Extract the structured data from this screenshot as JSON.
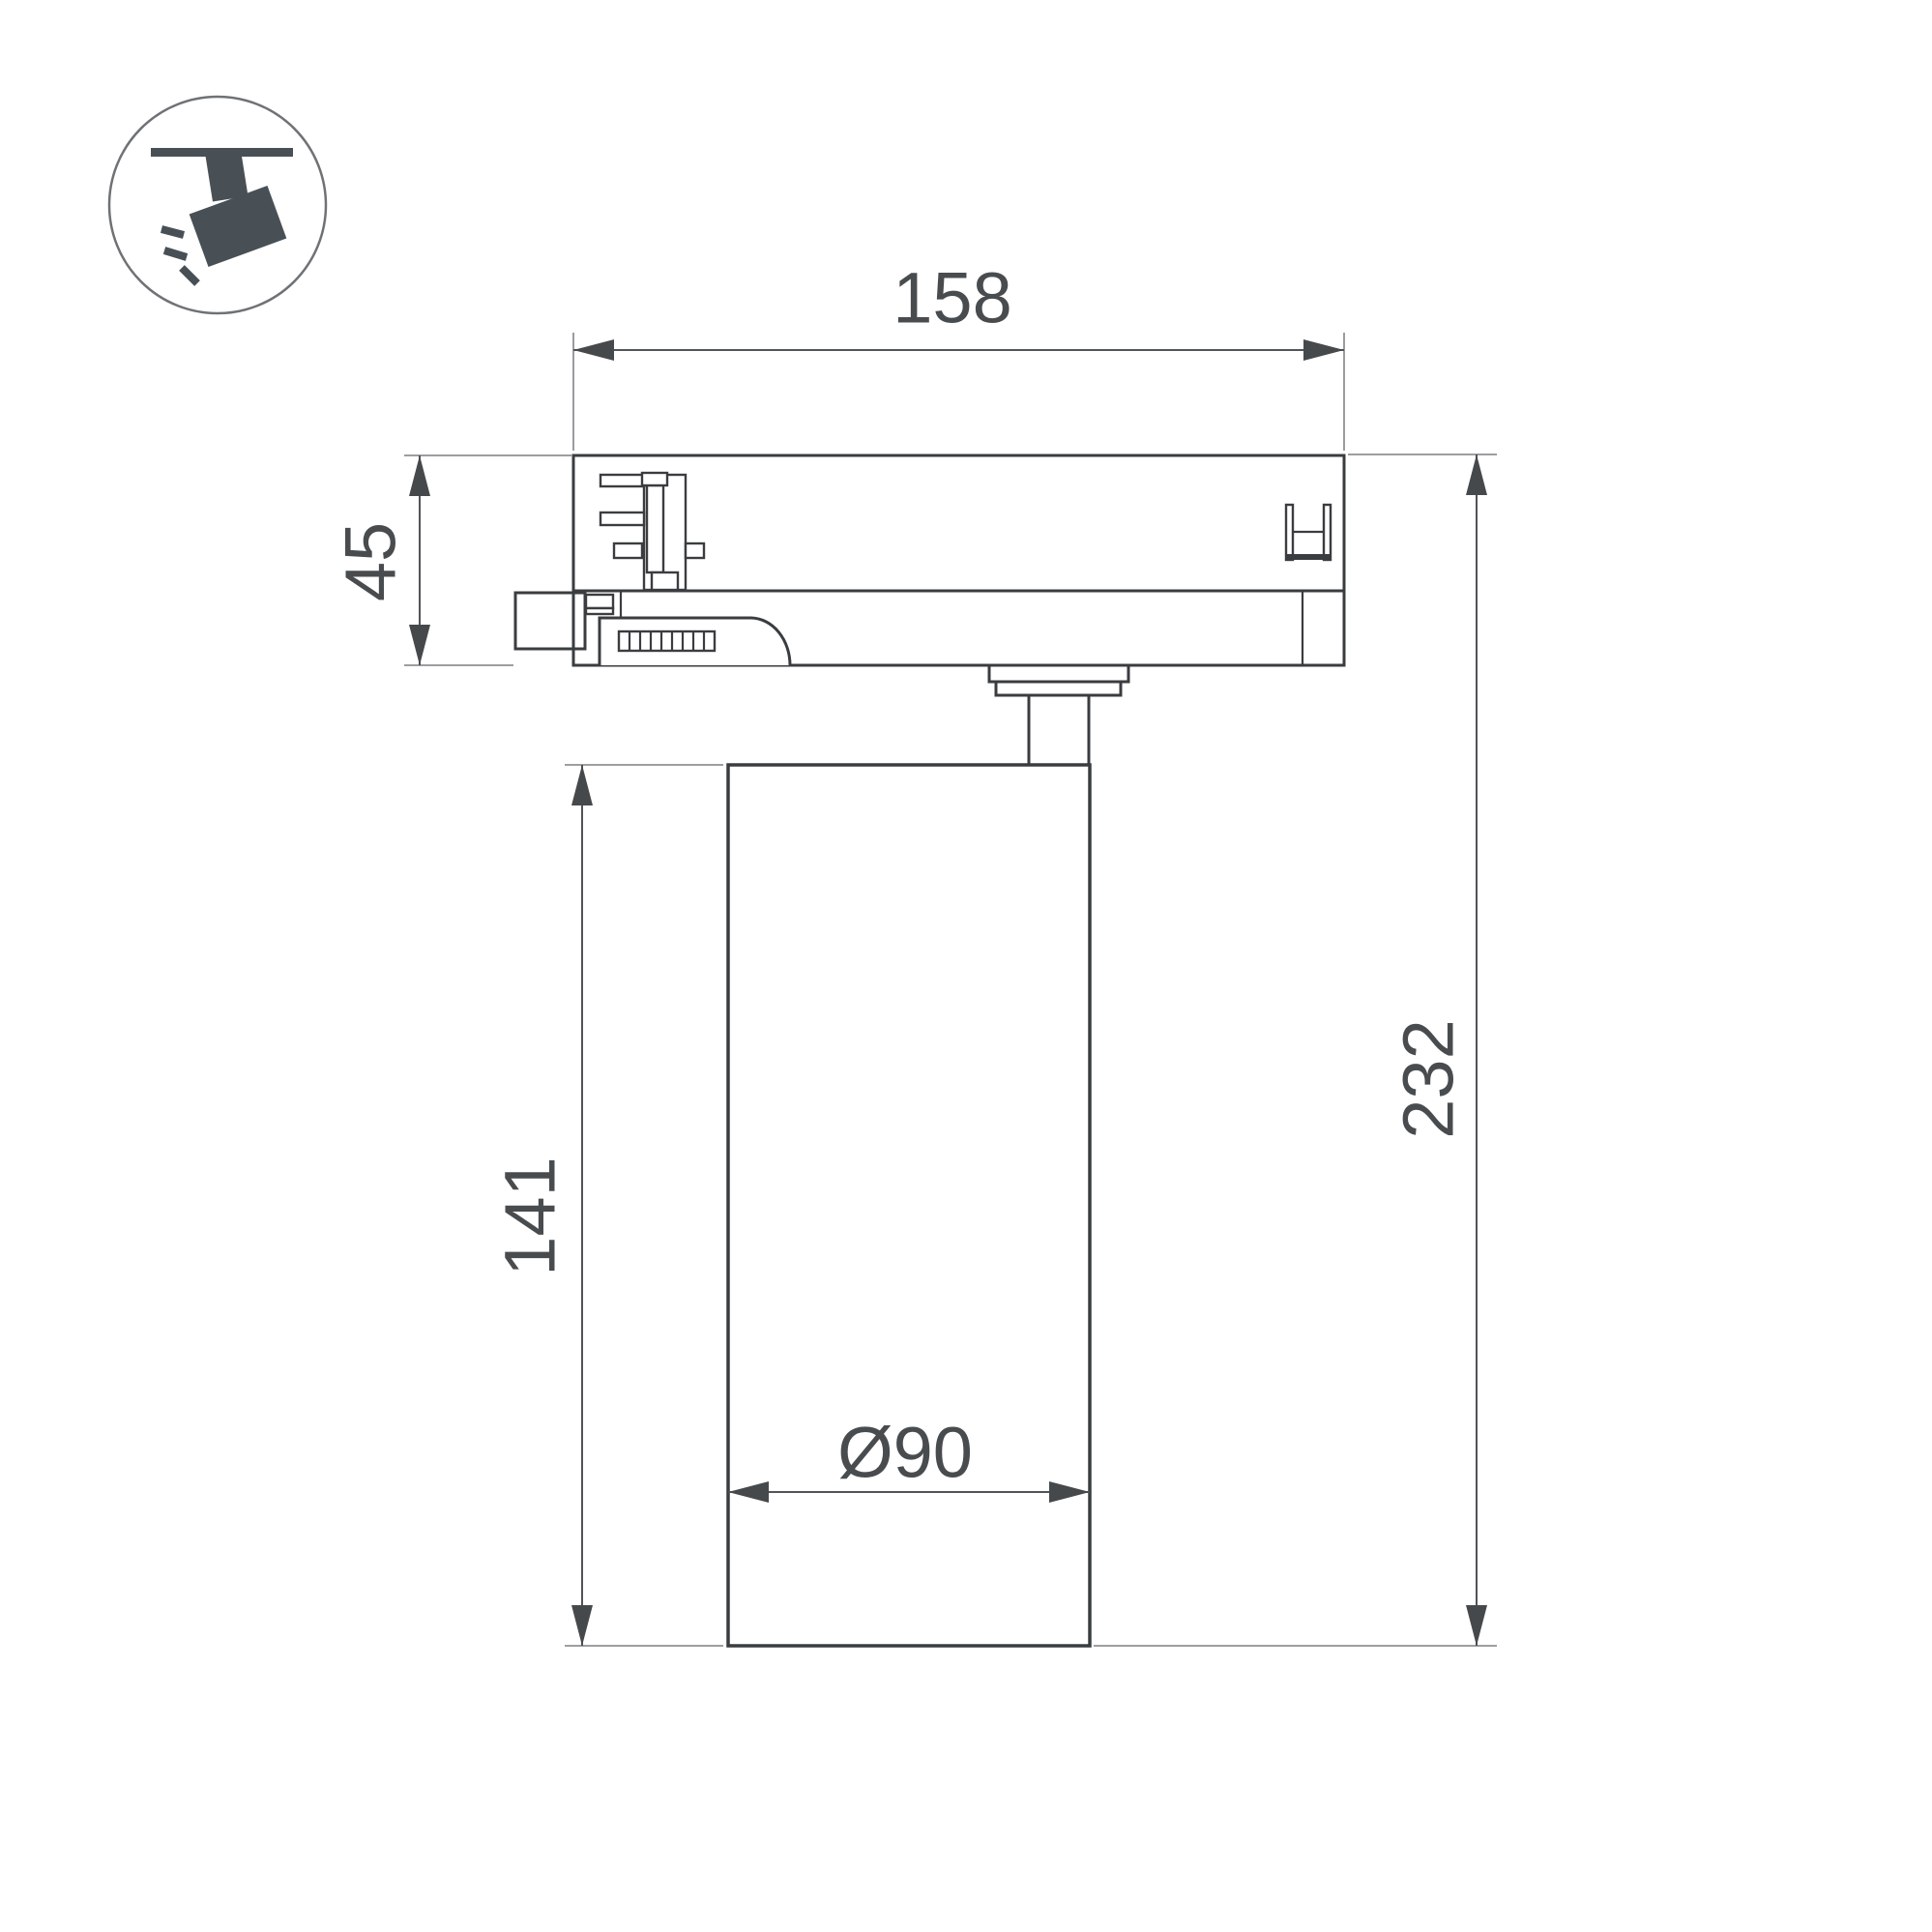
{
  "dimensions": {
    "track_width": "158",
    "adapter_height": "45",
    "body_height": "141",
    "total_height": "232",
    "body_diameter": "Ø90"
  },
  "icon": {
    "name": "track-spotlight-icon",
    "description": "spotlight hanging from track, tilted, with light rays"
  },
  "colors": {
    "background": "#ffffff",
    "part_outline": "#3a3d40",
    "dimension_line": "#515458",
    "extension_line": "#8f9193",
    "arrowhead": "#46494c",
    "label_text": "#494c4f",
    "icon_fill": "#485056",
    "icon_ring": "#6f7275"
  }
}
